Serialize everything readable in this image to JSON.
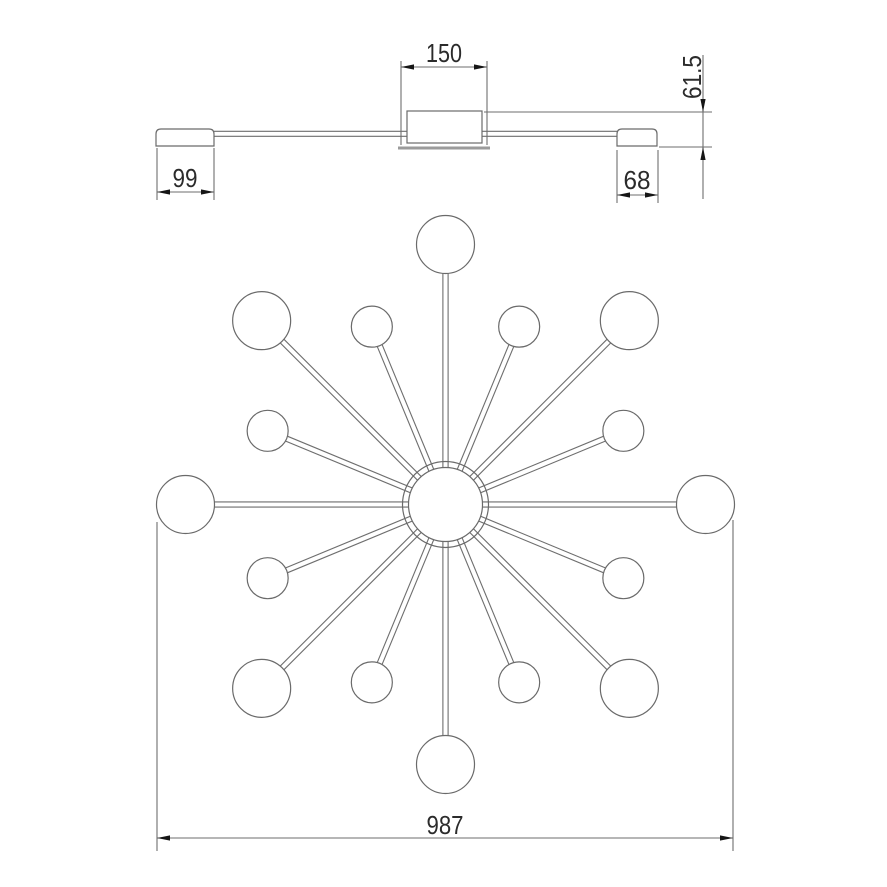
{
  "page": {
    "background": "#ffffff"
  },
  "drawing": {
    "type": "technical-dimension-drawing",
    "subject": "sputnik-style ceiling chandelier: side elevation (top) and plan view (bottom)",
    "colors": {
      "line": "#6e6e6e",
      "body": "#6a6a6a",
      "text": "#2b2b2b",
      "arrow": "#161616",
      "plate": "#9b9b9b",
      "fill": "#ffffff"
    },
    "dimensions": {
      "canopy_width": "150",
      "fixture_height": "61.5",
      "left_end_cap_length": "99",
      "right_end_cap_length": "68",
      "overall_diameter": "987"
    },
    "star": {
      "center": {
        "x": 445.5,
        "y": 504.5
      },
      "hub": {
        "outer_r": 43,
        "inner_r": 37
      },
      "arm_count": 16,
      "arm_half_gap": 2.6,
      "large_balls": {
        "count": 8,
        "radius": 29,
        "distance": 260,
        "angles_deg": [
          0,
          45,
          90,
          135,
          180,
          225,
          270,
          315
        ]
      },
      "small_balls": {
        "count": 8,
        "radius": 20.5,
        "distance": 192.5,
        "angles_deg": [
          22.5,
          67.5,
          112.5,
          157.5,
          202.5,
          247.5,
          292.5,
          337.5
        ]
      }
    }
  }
}
